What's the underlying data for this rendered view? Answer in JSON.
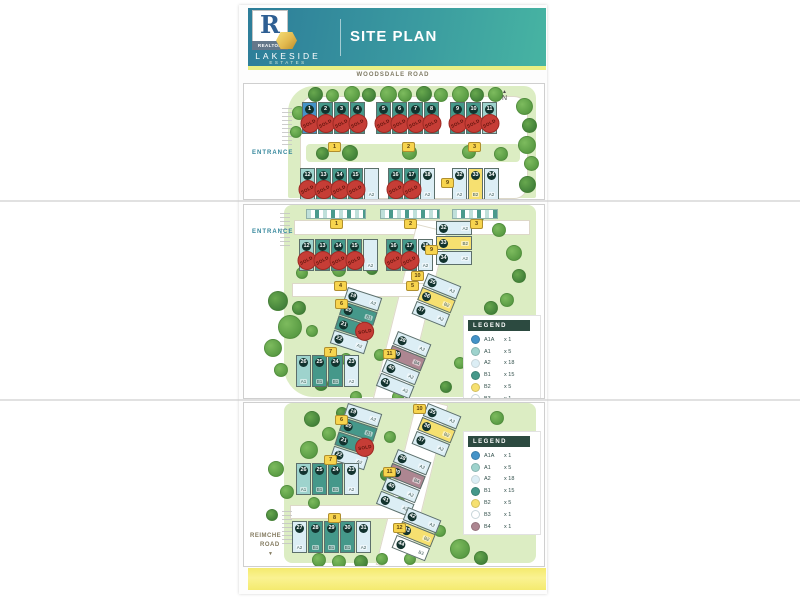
{
  "header": {
    "title": "SITE PLAN",
    "logo": {
      "r": "R",
      "realtor": "REALTOR",
      "brand1": "LAKESIDE",
      "brand2": "ESTATES"
    }
  },
  "roads": {
    "top": "WOODSDALE ROAD",
    "bottom": "REIMCHE ROAD"
  },
  "sold_label": "SOLD",
  "legend": {
    "title": "LEGEND",
    "items": [
      {
        "code": "A1A",
        "count": "x 1",
        "color": "#4493c8"
      },
      {
        "code": "A1",
        "count": "x 5",
        "color": "#9ed3cd"
      },
      {
        "code": "A2",
        "count": "x 18",
        "color": "#dceef5"
      },
      {
        "code": "B1",
        "count": "x 15",
        "color": "#45988a"
      },
      {
        "code": "B2",
        "count": "x 5",
        "color": "#f6e070"
      },
      {
        "code": "B3",
        "count": "x 1",
        "color": "#ffffff"
      },
      {
        "code": "B4",
        "count": "x 1",
        "color": "#ad8691"
      }
    ]
  },
  "panels": [
    {
      "name": "north-section",
      "compass": {
        "x": 258,
        "y": 6,
        "label": "N"
      },
      "labels": [
        {
          "text": "ENTRANCE",
          "x": 8,
          "y": 66,
          "cls": "entrance",
          "name": "entrance-label"
        }
      ],
      "trees": [
        [
          64,
          3,
          13
        ],
        [
          82,
          5,
          11
        ],
        [
          100,
          2,
          14
        ],
        [
          118,
          4,
          12
        ],
        [
          136,
          2,
          15
        ],
        [
          154,
          4,
          12
        ],
        [
          172,
          2,
          14
        ],
        [
          190,
          4,
          12
        ],
        [
          208,
          2,
          15
        ],
        [
          226,
          4,
          12
        ],
        [
          244,
          3,
          13
        ],
        [
          272,
          14,
          15
        ],
        [
          278,
          34,
          13
        ],
        [
          274,
          52,
          16
        ],
        [
          280,
          72,
          13
        ],
        [
          275,
          92,
          15
        ],
        [
          48,
          22,
          12
        ],
        [
          46,
          42,
          10
        ],
        [
          98,
          61,
          14
        ],
        [
          158,
          61,
          13
        ],
        [
          218,
          61,
          12
        ],
        [
          72,
          63,
          11
        ],
        [
          250,
          63,
          12
        ]
      ],
      "blocks": [
        {
          "badge": "1",
          "bx": 84,
          "by": 58,
          "x": 58,
          "y": 18,
          "units": [
            {
              "num": "1",
              "type": "A1A",
              "sold": true
            },
            {
              "num": "2",
              "type": "B1",
              "sold": true
            },
            {
              "num": "3",
              "type": "B1",
              "sold": true
            },
            {
              "num": "4",
              "type": "B1",
              "sold": true
            }
          ]
        },
        {
          "badge": "2",
          "bx": 158,
          "by": 58,
          "x": 132,
          "y": 18,
          "units": [
            {
              "num": "5",
              "type": "B1",
              "sold": true
            },
            {
              "num": "6",
              "type": "B1",
              "sold": true
            },
            {
              "num": "7",
              "type": "B1",
              "sold": true
            },
            {
              "num": "8",
              "type": "B1",
              "sold": true
            }
          ]
        },
        {
          "badge": "3",
          "bx": 224,
          "by": 58,
          "x": 206,
          "y": 18,
          "units": [
            {
              "num": "9",
              "type": "B1",
              "sold": true
            },
            {
              "num": "10",
              "type": "B1",
              "sold": true
            },
            {
              "num": "11",
              "type": "A1",
              "sold": true
            }
          ]
        },
        {
          "x": 56,
          "y": 84,
          "units": [
            {
              "num": "12",
              "type": "A1",
              "sold": true
            },
            {
              "num": "13",
              "type": "B1",
              "sold": true
            },
            {
              "num": "14",
              "type": "B1",
              "sold": true
            },
            {
              "num": "15",
              "type": "B1",
              "sold": true
            },
            {
              "type": "A2"
            }
          ]
        },
        {
          "x": 144,
          "y": 84,
          "units": [
            {
              "num": "16",
              "type": "B1",
              "sold": true
            },
            {
              "num": "17",
              "type": "B1",
              "sold": true
            },
            {
              "num": "18",
              "type": "A2"
            }
          ]
        },
        {
          "badge": "9",
          "bx": 197,
          "by": 94,
          "x": 208,
          "y": 84,
          "units": [
            {
              "num": "32",
              "type": "A2"
            },
            {
              "num": "33",
              "type": "B2"
            },
            {
              "num": "34",
              "type": "A2"
            }
          ]
        }
      ]
    },
    {
      "name": "central-section",
      "labels": [
        {
          "text": "ENTRANCE",
          "x": 8,
          "y": 24,
          "cls": "entrance",
          "name": "entrance-label"
        }
      ],
      "strips": [
        {
          "x": 62,
          "w": 58,
          "badge": "1",
          "bx": 86,
          "by": 14
        },
        {
          "x": 136,
          "w": 58,
          "badge": "2",
          "bx": 160,
          "by": 14
        },
        {
          "x": 208,
          "w": 44,
          "badge": "3",
          "bx": 226,
          "by": 14
        }
      ],
      "trees": [
        [
          24,
          86,
          18
        ],
        [
          34,
          110,
          22
        ],
        [
          20,
          134,
          16
        ],
        [
          48,
          96,
          12
        ],
        [
          62,
          120,
          10
        ],
        [
          30,
          158,
          12
        ],
        [
          70,
          172,
          12
        ],
        [
          52,
          62,
          10
        ],
        [
          88,
          58,
          12
        ],
        [
          122,
          58,
          10
        ],
        [
          96,
          148,
          10
        ],
        [
          130,
          144,
          10
        ],
        [
          228,
          6,
          10
        ],
        [
          248,
          18,
          12
        ],
        [
          262,
          40,
          14
        ],
        [
          268,
          64,
          12
        ],
        [
          256,
          88,
          12
        ],
        [
          210,
          152,
          10
        ],
        [
          196,
          176,
          10
        ],
        [
          148,
          186,
          10
        ],
        [
          106,
          186,
          10
        ],
        [
          240,
          96,
          12
        ]
      ],
      "blocks": [
        {
          "badge": "4",
          "bx": 90,
          "by": 76,
          "x": 55,
          "y": 34,
          "units": [
            {
              "num": "12",
              "type": "A1",
              "sold": true
            },
            {
              "num": "13",
              "type": "B1",
              "sold": true
            },
            {
              "num": "14",
              "type": "B1",
              "sold": true
            },
            {
              "num": "15",
              "type": "B1",
              "sold": true
            },
            {
              "type": "A2"
            }
          ]
        },
        {
          "badge": "5",
          "bx": 162,
          "by": 76,
          "x": 142,
          "y": 34,
          "units": [
            {
              "num": "16",
              "type": "B1",
              "sold": true
            },
            {
              "num": "17",
              "type": "B1",
              "sold": true
            },
            {
              "num": "18",
              "type": "A2"
            }
          ]
        },
        {
          "badge": "9",
          "bx": 181,
          "by": 40,
          "x": 192,
          "y": 16,
          "vertical": true,
          "units": [
            {
              "num": "32",
              "type": "A2"
            },
            {
              "num": "33",
              "type": "B2"
            },
            {
              "num": "34",
              "type": "A2"
            }
          ]
        },
        {
          "badge": "6",
          "bx": 91,
          "by": 94,
          "x": 104,
          "y": 82,
          "vertical": true,
          "rotate": 18,
          "units": [
            {
              "num": "19",
              "type": "A2"
            },
            {
              "num": "20",
              "type": "B1"
            },
            {
              "num": "21",
              "type": "B1",
              "sold": true
            },
            {
              "num": "22",
              "type": "A2"
            }
          ]
        },
        {
          "badge": "10",
          "bx": 167,
          "by": 66,
          "x": 184,
          "y": 68,
          "vertical": true,
          "rotate": 22,
          "units": [
            {
              "num": "35",
              "type": "A2"
            },
            {
              "num": "36",
              "type": "B2"
            },
            {
              "num": "37",
              "type": "A2"
            }
          ]
        },
        {
          "badge": "11",
          "bx": 139,
          "by": 144,
          "x": 154,
          "y": 126,
          "vertical": true,
          "rotate": 22,
          "units": [
            {
              "num": "38",
              "type": "A2"
            },
            {
              "num": "39",
              "type": "B4"
            },
            {
              "num": "40",
              "type": "A2"
            },
            {
              "num": "41",
              "type": "A2"
            }
          ]
        },
        {
          "badge": "7",
          "bx": 80,
          "by": 142,
          "x": 52,
          "y": 150,
          "units": [
            {
              "num": "26",
              "type": "A1"
            },
            {
              "num": "25",
              "type": "B1"
            },
            {
              "num": "24",
              "type": "B1"
            },
            {
              "num": "23",
              "type": "A2"
            }
          ]
        }
      ]
    },
    {
      "name": "south-section",
      "labels": [
        {
          "text": "REIMCHE",
          "x": 6,
          "y": 130,
          "cls": "roadlabel",
          "name": "reimche-road-label"
        },
        {
          "text": "ROAD",
          "x": 16,
          "y": 139,
          "cls": "roadlabel",
          "name": "reimche-road-label"
        },
        {
          "text": "▼",
          "x": 24,
          "y": 148,
          "cls": "arrow",
          "name": "road-direction-arrow"
        }
      ],
      "trees": [
        [
          60,
          8,
          14
        ],
        [
          78,
          24,
          12
        ],
        [
          56,
          38,
          16
        ],
        [
          92,
          4,
          10
        ],
        [
          24,
          58,
          14
        ],
        [
          36,
          82,
          12
        ],
        [
          22,
          106,
          10
        ],
        [
          64,
          94,
          10
        ],
        [
          140,
          28,
          10
        ],
        [
          136,
          66,
          10
        ],
        [
          148,
          94,
          12
        ],
        [
          246,
          8,
          12
        ],
        [
          260,
          28,
          14
        ],
        [
          252,
          54,
          12
        ],
        [
          264,
          78,
          12
        ],
        [
          254,
          102,
          14
        ],
        [
          68,
          150,
          12
        ],
        [
          88,
          152,
          12
        ],
        [
          110,
          152,
          12
        ],
        [
          132,
          150,
          10
        ],
        [
          206,
          136,
          18
        ],
        [
          230,
          148,
          12
        ],
        [
          190,
          122,
          10
        ],
        [
          160,
          150,
          10
        ]
      ],
      "blocks": [
        {
          "badge": "6",
          "bx": 91,
          "by": 12,
          "x": 104,
          "y": 0,
          "vertical": true,
          "rotate": 18,
          "units": [
            {
              "num": "19",
              "type": "A2"
            },
            {
              "num": "20",
              "type": "B1"
            },
            {
              "num": "21",
              "type": "B1",
              "sold": true
            },
            {
              "num": "22",
              "type": "A2"
            }
          ]
        },
        {
          "badge": "10",
          "bx": 169,
          "by": 1,
          "x": 184,
          "y": 0,
          "vertical": true,
          "rotate": 22,
          "units": [
            {
              "num": "35",
              "type": "A2"
            },
            {
              "num": "36",
              "type": "B2"
            },
            {
              "num": "37",
              "type": "A2"
            }
          ]
        },
        {
          "badge": "7",
          "bx": 80,
          "by": 52,
          "x": 52,
          "y": 60,
          "units": [
            {
              "num": "26",
              "type": "A1"
            },
            {
              "num": "25",
              "type": "B1"
            },
            {
              "num": "24",
              "type": "B1"
            },
            {
              "num": "23",
              "type": "A2"
            }
          ]
        },
        {
          "badge": "11",
          "bx": 139,
          "by": 64,
          "x": 154,
          "y": 46,
          "vertical": true,
          "rotate": 22,
          "units": [
            {
              "num": "38",
              "type": "A2"
            },
            {
              "num": "39",
              "type": "B4"
            },
            {
              "num": "40",
              "type": "A2"
            },
            {
              "num": "41",
              "type": "A2"
            }
          ]
        },
        {
          "badge": "8",
          "bx": 84,
          "by": 110,
          "x": 48,
          "y": 118,
          "units": [
            {
              "num": "27",
              "type": "A2"
            },
            {
              "num": "28",
              "type": "B1"
            },
            {
              "num": "29",
              "type": "B1"
            },
            {
              "num": "30",
              "type": "B1"
            },
            {
              "num": "31",
              "type": "A2"
            }
          ]
        },
        {
          "badge": "12",
          "bx": 149,
          "by": 120,
          "x": 164,
          "y": 104,
          "vertical": true,
          "rotate": 22,
          "units": [
            {
              "num": "42",
              "type": "A2"
            },
            {
              "num": "43",
              "type": "B2"
            },
            {
              "num": "44",
              "type": "B3"
            }
          ]
        }
      ]
    }
  ]
}
